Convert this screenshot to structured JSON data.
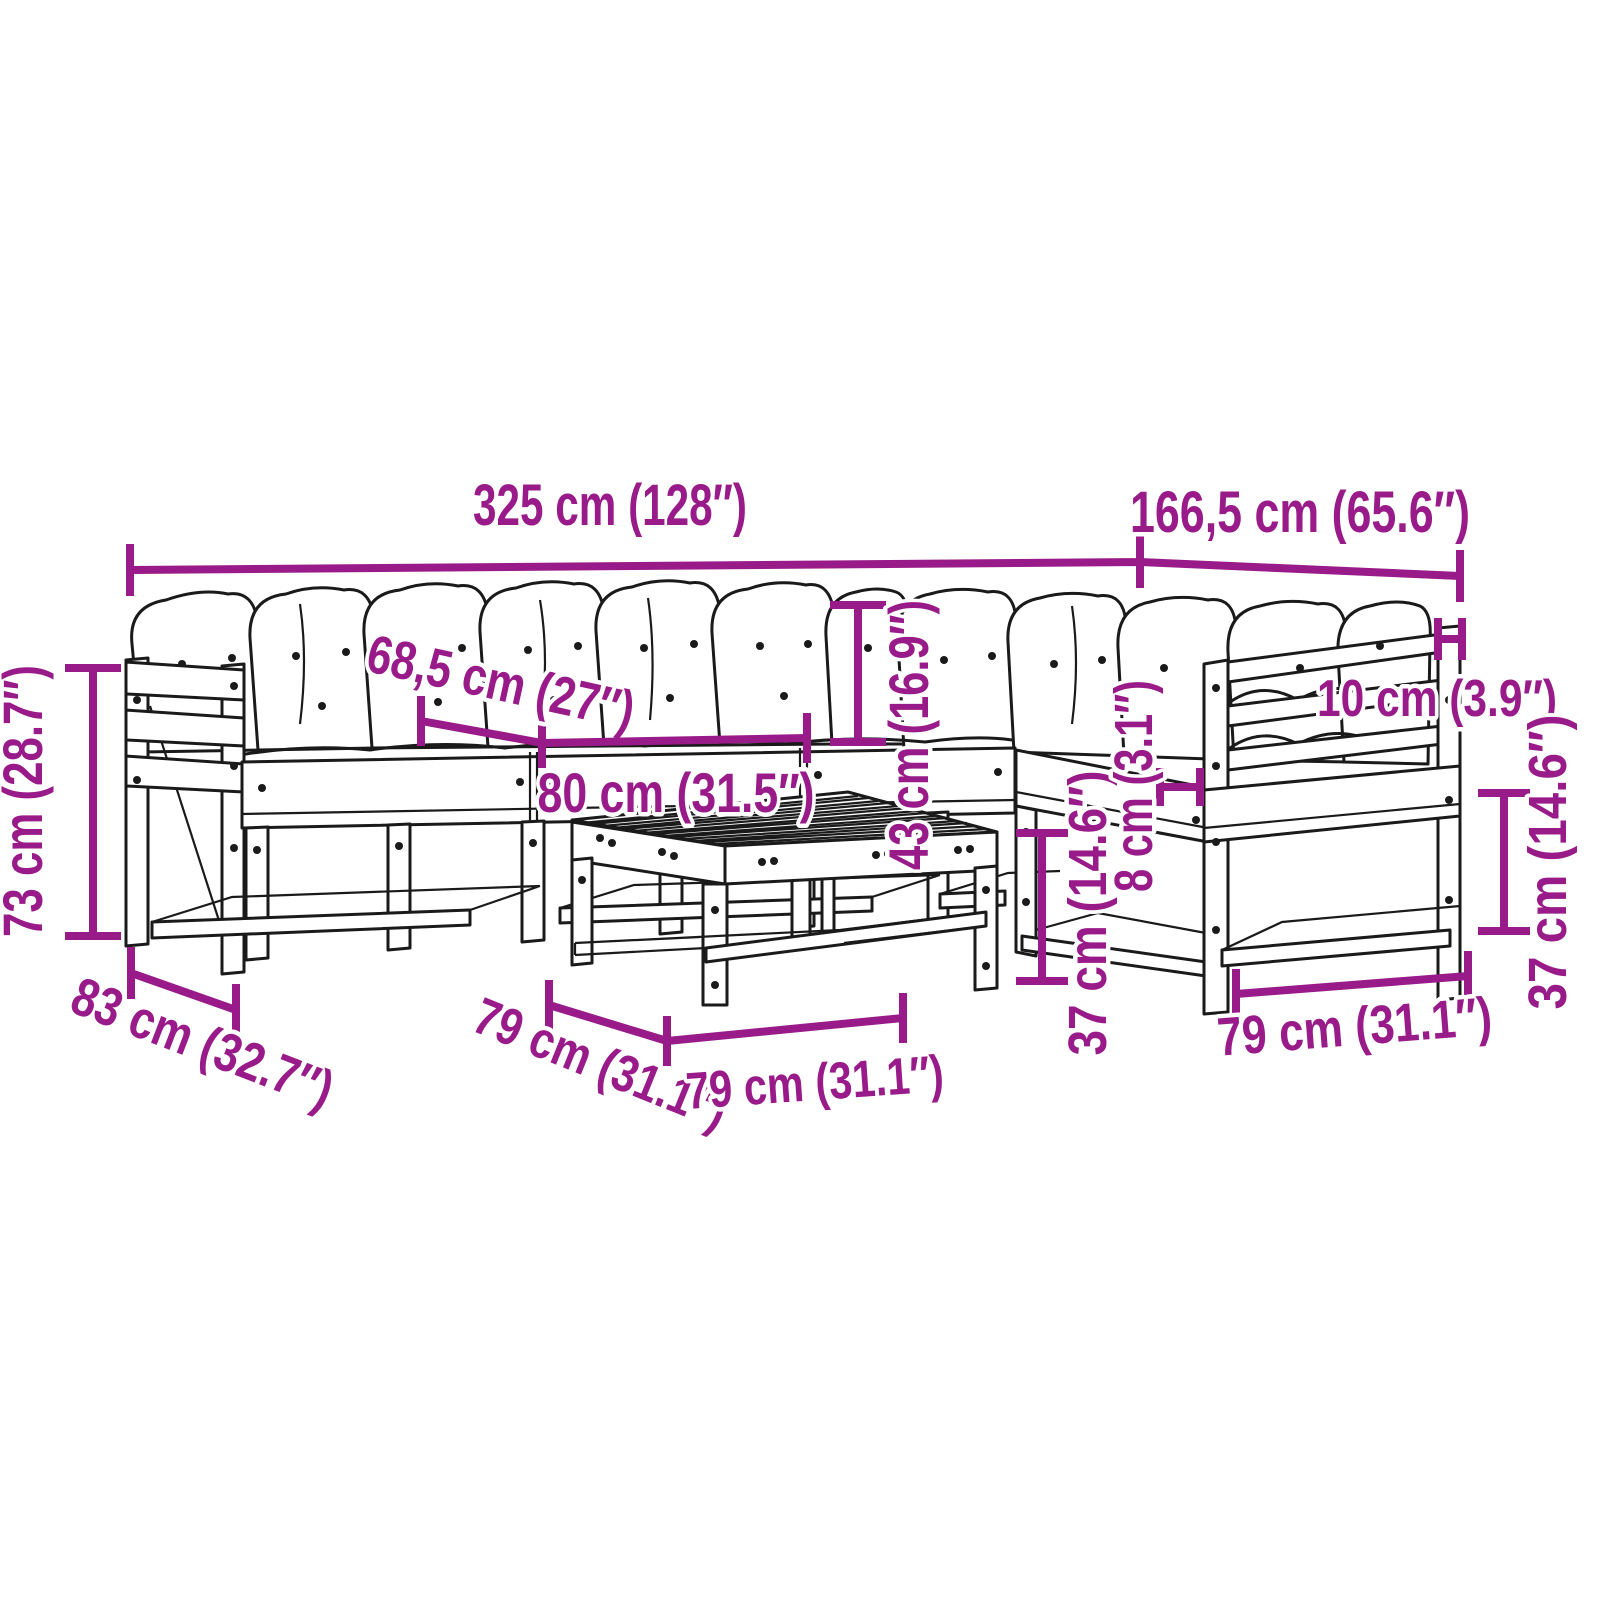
{
  "diagram": {
    "type": "furniture-dimension-diagram",
    "subject": "garden lounge set with cushions and coffee table",
    "colors": {
      "accent": "#991A89",
      "line": "#1A1A1A",
      "background": "#FFFFFF"
    },
    "dimensions": [
      {
        "name": "overall-width",
        "label": "325 cm (128″)"
      },
      {
        "name": "right-section-width",
        "label": "166,5 cm (65.6″)"
      },
      {
        "name": "seat-module-width",
        "label": "68,5 cm (27″)"
      },
      {
        "name": "seat-depth",
        "label": "80 cm (31.5″)"
      },
      {
        "name": "back-cushion-height",
        "label": "43 cm (16.9″)"
      },
      {
        "name": "overall-height",
        "label": "73 cm (28.7″)"
      },
      {
        "name": "overall-depth",
        "label": "83 cm (32.7″)"
      },
      {
        "name": "table-depth",
        "label": "79 cm (31.1″)"
      },
      {
        "name": "table-width",
        "label": "79 cm (31.1″)"
      },
      {
        "name": "table-height",
        "label": "37 cm (14.6″)"
      },
      {
        "name": "cushion-thickness",
        "label": "8 cm (3.1″)"
      },
      {
        "name": "armrest-width",
        "label": "10 cm (3.9″)"
      },
      {
        "name": "seat-height",
        "label": "37 cm (14.6″)"
      },
      {
        "name": "seat-unit-width",
        "label": "79 cm (31.1″)"
      }
    ]
  }
}
